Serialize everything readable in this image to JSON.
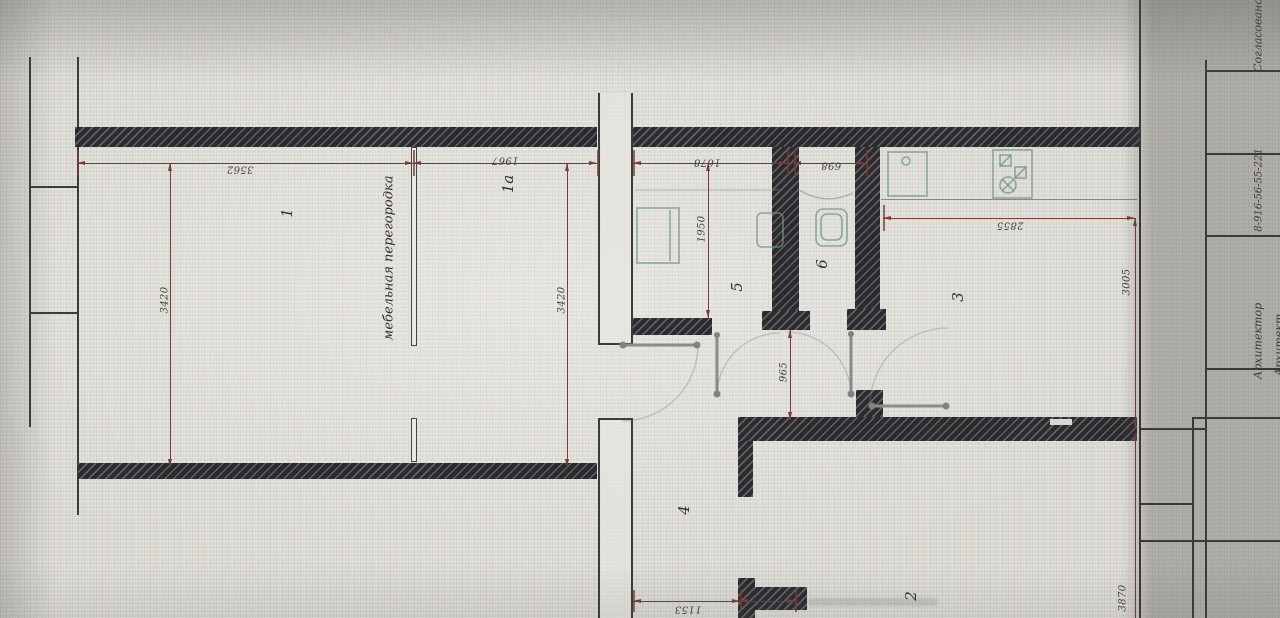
{
  "plan": {
    "rooms": {
      "r1": "1",
      "r1a": "1а",
      "r2": "2",
      "r3": "3",
      "r4": "4",
      "r5": "5",
      "r6": "6"
    },
    "dims": {
      "top_room1": "3562",
      "top_room1a": "1967",
      "top_hall": "1678",
      "top_wc": "698",
      "kitchen_w": "2855",
      "room1_h": "3420",
      "room1a_h": "3420",
      "bath_h": "1950",
      "lobby_h": "965",
      "kitchen_h": "3005",
      "room2_h": "3870",
      "hall_w": "1153"
    },
    "annotations": {
      "furniture_partition": "мебельная перегородка"
    },
    "title_block": {
      "approved": "Согласовано",
      "phone": "8-916-56-55-221",
      "architect": "Архитектор",
      "architect_partial": "Архитект"
    },
    "colors": {
      "dimension": "#7b3a33",
      "wall": "#2b2a2d",
      "fixture": "#6e9683"
    }
  }
}
